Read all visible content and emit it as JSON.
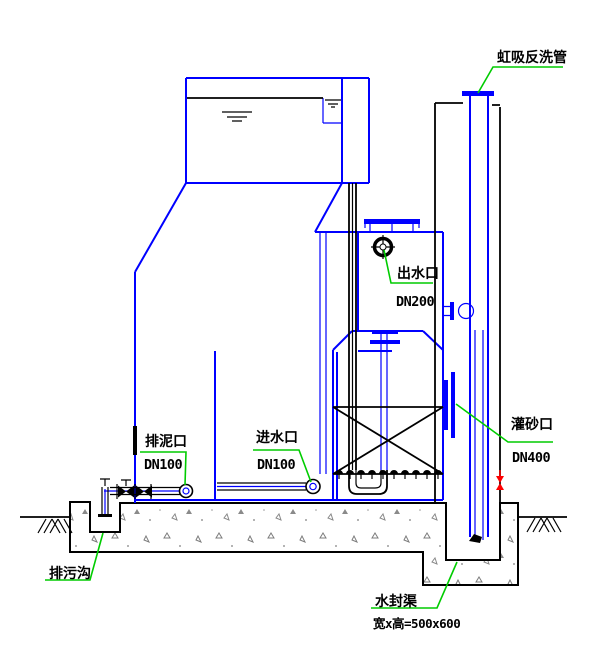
{
  "diagram": {
    "type": "engineering-cad-cross-section",
    "subject": "siphon filter tank installation drawing",
    "labels": {
      "siphon_backwash_pipe": "虹吸反洗管",
      "outlet_port": "出水口",
      "outlet_dn": "DN200",
      "mud_drain_port": "排泥口",
      "mud_drain_dn": "DN100",
      "inlet_port": "进水口",
      "inlet_dn": "DN100",
      "sand_fill_port": "灌砂口",
      "sand_fill_dn": "DN400",
      "sewage_ditch": "排污沟",
      "water_seal_channel": "水封渠",
      "water_seal_channel_size": "宽x高=500x600"
    },
    "colors": {
      "structure_blue": "#0000ff",
      "line_black": "#000000",
      "leader_green": "#00cc00",
      "valve_red": "#ff0000",
      "concrete_gray": "#7d7d7d",
      "background": "#ffffff"
    }
  }
}
